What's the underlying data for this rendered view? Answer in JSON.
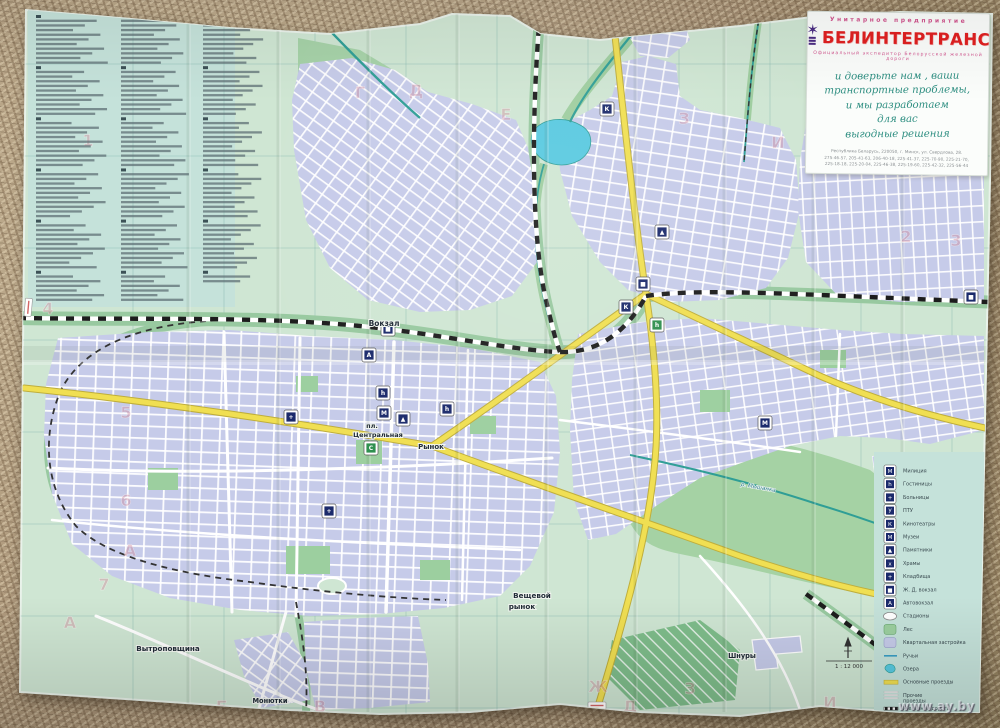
{
  "photo": {
    "watermark": "www.ay.by"
  },
  "ad_box": {
    "org_type": "Унитарное предприятие",
    "brand": "БЕЛИНТЕРТРАНС",
    "subtitle": "Официальный экспедитор Белорусской железной дороги",
    "slogan_lines": [
      "и доверьте нам ,  ваши",
      "транспортные проблемы,",
      "и мы разработаем",
      "для  вас",
      "выгодные решения"
    ],
    "address_line1": "Республика Беларусь, 220050, г. Минск, ул. Свердлова, 28.",
    "address_line2": "275-46-57, 205-41-63, 206-40-18, 225-41-37, 225-70-90, 225-21-70,",
    "address_line3": "225-18-18, 225-20-04, 225-46-38, 225-19-60, 225-42-32, 225-56-44"
  },
  "street_index": {
    "columns": [
      62,
      62,
      58
    ]
  },
  "map": {
    "labels": {
      "vokzal": "Вокзал",
      "pl_line1": "пл.",
      "pl_line2": "Центральная",
      "rynok": "Рынок",
      "vesh_line1": "Вещевой",
      "vesh_line2": "рынок",
      "vytropovschina": "Вытроповщина",
      "monutki": "Монютки",
      "shnury": "Шнуры",
      "river": "р. Мышанка",
      "scale_text": "1 : 12 000"
    },
    "pois": [
      {
        "name": "railway-station-icon",
        "x": 388,
        "y": 329,
        "glyph": "■",
        "bg": "#1b2a6b"
      },
      {
        "name": "railway-station-icon",
        "x": 643,
        "y": 284,
        "glyph": "■",
        "bg": "#1b2a6b"
      },
      {
        "name": "hotel-icon",
        "x": 383,
        "y": 393,
        "glyph": "h",
        "bg": "#1b2a6b"
      },
      {
        "name": "hotel-icon",
        "x": 447,
        "y": 409,
        "glyph": "h",
        "bg": "#1b2a6b"
      },
      {
        "name": "hotel-icon",
        "x": 657,
        "y": 325,
        "glyph": "h",
        "bg": "#2e8f4e"
      },
      {
        "name": "cinema-icon",
        "x": 626,
        "y": 307,
        "glyph": "К",
        "bg": "#1b2a6b"
      },
      {
        "name": "cinema-icon",
        "x": 607,
        "y": 109,
        "glyph": "К",
        "bg": "#1b2a6b"
      },
      {
        "name": "museum-icon",
        "x": 384,
        "y": 413,
        "glyph": "М",
        "bg": "#1b2a6b"
      },
      {
        "name": "monument-icon",
        "x": 662,
        "y": 232,
        "glyph": "▲",
        "bg": "#1b2a6b"
      },
      {
        "name": "monument-icon",
        "x": 403,
        "y": 419,
        "glyph": "▲",
        "bg": "#1b2a6b"
      },
      {
        "name": "bus-station-icon",
        "x": 369,
        "y": 355,
        "glyph": "А",
        "bg": "#1b2a6b"
      },
      {
        "name": "stadium-icon",
        "x": 371,
        "y": 448,
        "glyph": "С",
        "bg": "#2e8f4e"
      },
      {
        "name": "church-icon",
        "x": 329,
        "y": 511,
        "glyph": "+",
        "bg": "#1b2a6b"
      },
      {
        "name": "police-icon",
        "x": 765,
        "y": 423,
        "glyph": "М",
        "bg": "#1b2a6b"
      },
      {
        "name": "railway-station-icon",
        "x": 971,
        "y": 297,
        "glyph": "■",
        "bg": "#1b2a6b"
      },
      {
        "name": "hospital-icon",
        "x": 291,
        "y": 417,
        "glyph": "+",
        "bg": "#1b2a6b"
      }
    ],
    "grid_refs": [
      {
        "ch": "Г",
        "x": 360,
        "y": 98
      },
      {
        "ch": "Д",
        "x": 416,
        "y": 96
      },
      {
        "ch": "Е",
        "x": 506,
        "y": 120
      },
      {
        "ch": "З",
        "x": 684,
        "y": 124
      },
      {
        "ch": "И",
        "x": 778,
        "y": 148
      },
      {
        "ch": "1",
        "x": 88,
        "y": 146
      },
      {
        "ch": "4",
        "x": 48,
        "y": 314
      },
      {
        "ch": "5",
        "x": 126,
        "y": 418
      },
      {
        "ch": "6",
        "x": 126,
        "y": 506
      },
      {
        "ch": "7",
        "x": 104,
        "y": 590
      },
      {
        "ch": "А",
        "x": 130,
        "y": 556
      },
      {
        "ch": "А",
        "x": 70,
        "y": 628
      },
      {
        "ch": "Б",
        "x": 222,
        "y": 712
      },
      {
        "ch": "В",
        "x": 320,
        "y": 712
      },
      {
        "ch": "Д",
        "x": 630,
        "y": 712
      },
      {
        "ch": "Ж",
        "x": 598,
        "y": 692
      },
      {
        "ch": "З",
        "x": 690,
        "y": 694
      },
      {
        "ch": "И",
        "x": 830,
        "y": 708
      },
      {
        "ch": "2",
        "x": 906,
        "y": 242
      },
      {
        "ch": "3",
        "x": 956,
        "y": 246
      }
    ]
  },
  "legend": {
    "items": [
      {
        "type": "poi",
        "glyph": "М",
        "label": "Милиция",
        "name": "legend-police"
      },
      {
        "type": "poi",
        "glyph": "h",
        "label": "Гостиницы",
        "name": "legend-hotels"
      },
      {
        "type": "poi",
        "glyph": "+",
        "label": "Больницы",
        "name": "legend-hospitals"
      },
      {
        "type": "poi",
        "glyph": "У",
        "label": "ПТУ",
        "name": "legend-ptu"
      },
      {
        "type": "poi",
        "glyph": "К",
        "label": "Кинотеатры",
        "name": "legend-cinemas"
      },
      {
        "type": "poi",
        "glyph": "М",
        "label": "Музеи",
        "name": "legend-museums"
      },
      {
        "type": "poi",
        "glyph": "▲",
        "label": "Памятники",
        "name": "legend-monuments"
      },
      {
        "type": "poi",
        "glyph": "х",
        "label": "Храмы",
        "name": "legend-churches"
      },
      {
        "type": "poi",
        "glyph": "+",
        "label": "Кладбища",
        "name": "legend-cemeteries"
      },
      {
        "type": "poi",
        "glyph": "■",
        "label": "Ж. Д. вокзал",
        "name": "legend-rail-station"
      },
      {
        "type": "poi",
        "glyph": "А",
        "label": "Автовокзал",
        "name": "legend-bus-station"
      },
      {
        "type": "ellipse",
        "label": "Стадионы",
        "name": "legend-stadiums"
      },
      {
        "type": "green",
        "label": "Лес",
        "name": "legend-forest"
      },
      {
        "type": "lavender",
        "label": "Квартальная застройка",
        "name": "legend-builtup"
      },
      {
        "type": "stream",
        "label": "Ручьи",
        "name": "legend-streams"
      },
      {
        "type": "lake",
        "label": "Озера",
        "name": "legend-lakes"
      },
      {
        "type": "mainroad",
        "label": "Основные проезды",
        "name": "legend-main-roads"
      },
      {
        "type": "otherroads",
        "label": "Прочие",
        "label2": "проезды",
        "name": "legend-other-roads"
      },
      {
        "type": "railway",
        "label": "Железная дорога",
        "name": "legend-railway"
      }
    ]
  },
  "colors": {
    "paper": "#cfe6d3",
    "panel": "#c5e2da",
    "builtup": "#c6cbe9",
    "forest": "#a6d2a8",
    "greenbelt": "#98c9a0",
    "water": "#58c9e0",
    "stream": "#2f9e96",
    "main_road": "#f0df52",
    "brand_red": "#e02020",
    "slogan_teal": "#2f8f82",
    "icon_navy": "#1b2a6b"
  }
}
